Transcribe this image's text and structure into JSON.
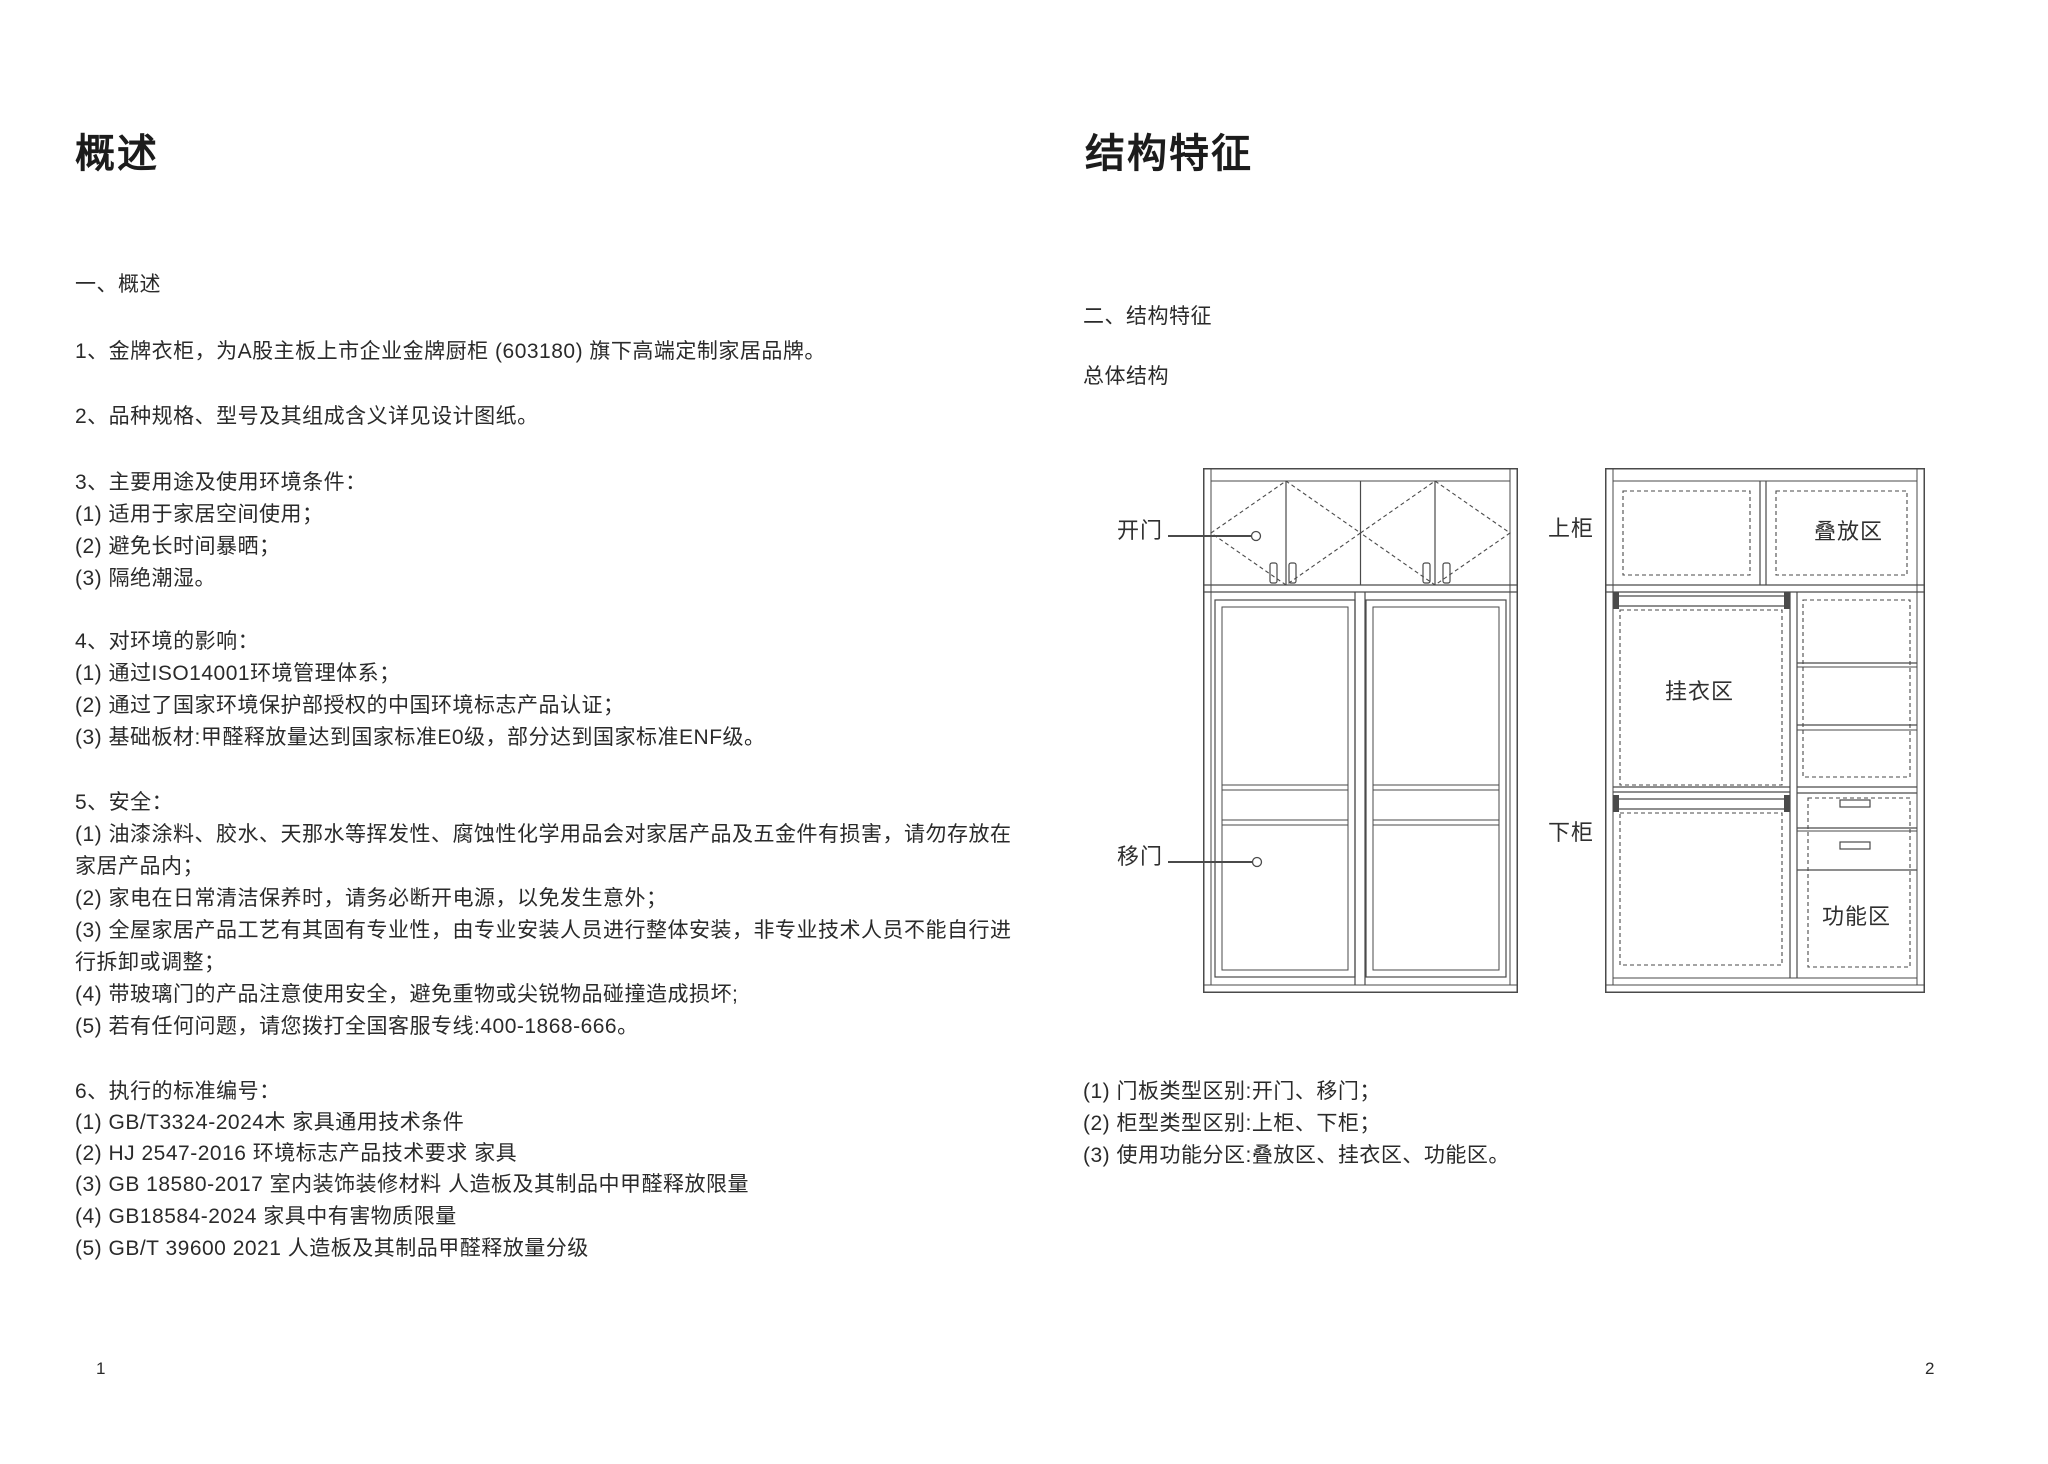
{
  "page_left": {
    "title": "概述",
    "page_number": "1",
    "lines": [
      {
        "t": "一、概述",
        "y": 270
      },
      {
        "t": "1、金牌衣柜，为A股主板上市企业金牌厨柜 (603180) 旗下高端定制家居品牌。",
        "y": 337
      },
      {
        "t": "2、品种规格、型号及其组成含义详见设计图纸。",
        "y": 402
      },
      {
        "t": "3、主要用途及使用环境条件：",
        "y": 468
      },
      {
        "t": "(1) 适用于家居空间使用；",
        "y": 500
      },
      {
        "t": "(2) 避免长时间暴晒；",
        "y": 532
      },
      {
        "t": "(3) 隔绝潮湿。",
        "y": 564
      },
      {
        "t": "4、对环境的影响：",
        "y": 627
      },
      {
        "t": "(1) 通过ISO14001环境管理体系；",
        "y": 659
      },
      {
        "t": "(2) 通过了国家环境保护部授权的中国环境标志产品认证；",
        "y": 691
      },
      {
        "t": "(3) 基础板材:甲醛释放量达到国家标准E0级，部分达到国家标准ENF级。",
        "y": 723
      },
      {
        "t": "5、安全：",
        "y": 788
      },
      {
        "t": "(1) 油漆涂料、胶水、天那水等挥发性、腐蚀性化学用品会对家居产品及五金件有损害，请勿存放在",
        "y": 820
      },
      {
        "t": "家居产品内；",
        "y": 852
      },
      {
        "t": "(2) 家电在日常清洁保养时，请务必断开电源，以免发生意外；",
        "y": 884
      },
      {
        "t": "(3) 全屋家居产品工艺有其固有专业性，由专业安装人员进行整体安装，非专业技术人员不能自行进",
        "y": 916
      },
      {
        "t": "行拆卸或调整；",
        "y": 948
      },
      {
        "t": "(4) 带玻璃门的产品注意使用安全，避免重物或尖锐物品碰撞造成损坏;",
        "y": 980
      },
      {
        "t": "(5) 若有任何问题，请您拨打全国客服专线:400-1868-666。",
        "y": 1012
      },
      {
        "t": "6、执行的标准编号：",
        "y": 1077
      },
      {
        "t": "(1) GB/T3324-2024木 家具通用技术条件",
        "y": 1108
      },
      {
        "t": "(2) HJ 2547-2016 环境标志产品技术要求 家具",
        "y": 1139
      },
      {
        "t": "(3) GB 18580-2017 室内装饰装修材料 人造板及其制品中甲醛释放限量",
        "y": 1170
      },
      {
        "t": "(4) GB18584-2024 家具中有害物质限量",
        "y": 1202
      },
      {
        "t": "(5) GB/T 39600 2021 人造板及其制品甲醛释放量分级",
        "y": 1234
      }
    ]
  },
  "page_right": {
    "title": "结构特征",
    "page_number": "2",
    "lines": [
      {
        "t": "二、结构特征",
        "y": 302
      },
      {
        "t": "总体结构",
        "y": 362
      },
      {
        "t": "(1) 门板类型区别:开门、移门；",
        "y": 1077
      },
      {
        "t": "(2) 柜型类型区别:上柜、下柜；",
        "y": 1109
      },
      {
        "t": "(3) 使用功能分区:叠放区、挂衣区、功能区。",
        "y": 1141
      }
    ]
  },
  "diagram": {
    "left_wardrobe_labels": {
      "open_door": "开门",
      "sliding_door": "移门"
    },
    "right_wardrobe_labels": {
      "upper_cabinet": "上柜",
      "lower_cabinet": "下柜",
      "stack_zone": "叠放区",
      "hang_zone": "挂衣区",
      "function_zone": "功能区"
    }
  },
  "colors": {
    "line": "#4a4a4a",
    "text": "#2a2a2a",
    "title": "#1c1c1c"
  }
}
